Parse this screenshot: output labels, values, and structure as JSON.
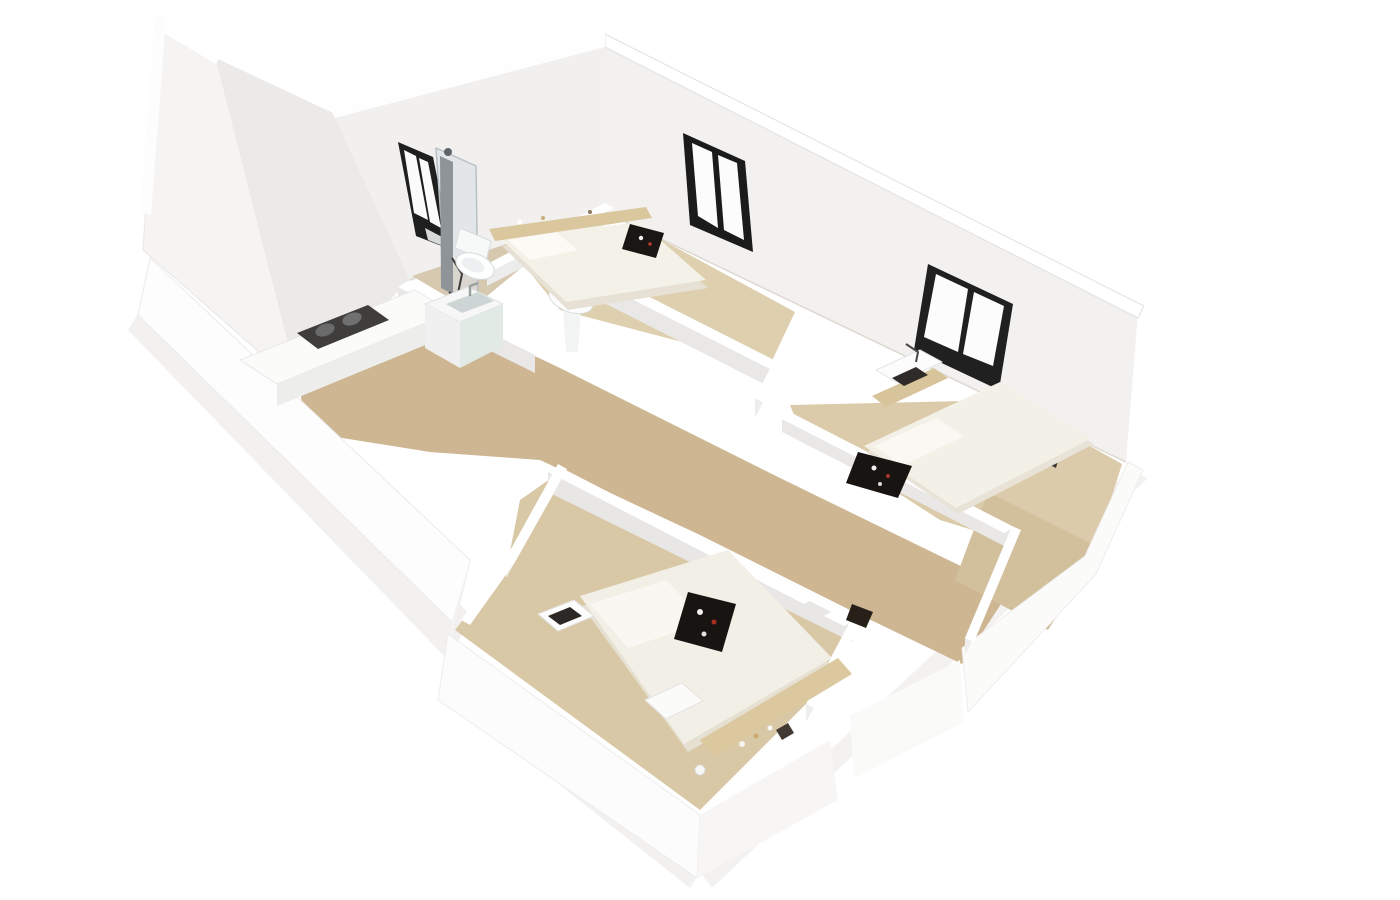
{
  "figure": {
    "kind": "3d-floor-plan-render",
    "description": "Isometric dollhouse cutaway render of a three-bedroom apartment with white walls and light wood floors",
    "rooms": [
      {
        "name": "kitchen",
        "furniture": [
          "counter",
          "gas-hob",
          "sink-cabinet"
        ]
      },
      {
        "name": "bathroom",
        "furniture": [
          "shower-column",
          "toilet",
          "window"
        ]
      },
      {
        "name": "hallway",
        "furniture": [
          "pedestal-sink",
          "bag"
        ]
      },
      {
        "name": "bedroom-1",
        "furniture": [
          "double-bed",
          "headboard-shelf",
          "breakfast-tray",
          "window"
        ]
      },
      {
        "name": "bedroom-2",
        "furniture": [
          "double-bed",
          "desk",
          "laptop",
          "desk-lamp",
          "breakfast-tray",
          "window"
        ]
      },
      {
        "name": "bedroom-3",
        "furniture": [
          "double-bed",
          "headboard-shelf",
          "breakfast-tray",
          "desk",
          "laptop",
          "stool",
          "bedside-lamp"
        ]
      }
    ],
    "palette": {
      "background": "#ffffff",
      "floor_wood": "#cdb691",
      "floor_light": "#decfae",
      "wall_top": "#ffffff",
      "wall_face": "#f2f1f0",
      "wall_shadow": "#e9e8e7",
      "window_frame": "#1f1f1f",
      "bedding": "#f3f0e7",
      "wood_trim": "#dbc79e",
      "tray_dark": "#181512",
      "accent_red": "#aa3429",
      "fixture_white": "#f7f9f9"
    }
  },
  "scene": {
    "width": 1400,
    "height": 900,
    "background": "#ffffff",
    "shapes": [
      {
        "n": "ground-shadow-west",
        "t": "p",
        "p": "140,310 468,612 452,664 128,330",
        "f": "#f2f1f0"
      },
      {
        "n": "ground-shadow-south",
        "t": "p",
        "p": "452,664 700,872 690,888 440,690",
        "f": "#f2f1f0"
      },
      {
        "n": "ground-shadow-east",
        "t": "p",
        "p": "700,872 1130,470 1148,478 712,888",
        "f": "#f3f2f1"
      },
      {
        "n": "wall-west-tall-face",
        "t": "p",
        "p": "158,16 216,58 300,388 143,250",
        "f": "#f5f4f3",
        "s": "#e8e7e6",
        "w": 1
      },
      {
        "n": "wall-west-step-face",
        "t": "p",
        "p": "216,58 333,113 410,280 300,388",
        "f": "#eceae9"
      },
      {
        "n": "wall-northwest-bath-face",
        "t": "p",
        "p": "333,113 605,42 605,212 410,280",
        "f": "#f1f0ef"
      },
      {
        "n": "wall-west-top-strip",
        "t": "p",
        "p": "155,13 222,53 216,64 149,24",
        "f": "#ffffff"
      },
      {
        "n": "wall-west-edge-strip",
        "t": "p",
        "p": "155,13 140,212 151,215 166,19",
        "f": "#fdfdfd"
      },
      {
        "n": "wall-northeast-face",
        "t": "p",
        "p": "605,42 1138,312 1126,462 605,212",
        "f": "#f2f1f0"
      },
      {
        "n": "wall-northeast-top-strip",
        "t": "p",
        "p": "605,34 1144,306 1138,318 605,47",
        "f": "#ffffff",
        "s": "#e2e1e0",
        "w": 1
      },
      {
        "n": "wall-northwest-top-strip",
        "t": "p",
        "p": "329,106 605,34 605,47 335,118",
        "f": "#fefefe"
      },
      {
        "n": "wall-northeast-floor-line",
        "t": "l",
        "p": "605,212 1126,462",
        "s": "#ddd8d0",
        "w": 1.5
      },
      {
        "n": "wall-northwest-floor-line",
        "t": "l",
        "p": "410,280 605,212",
        "s": "#ddd8d0",
        "w": 1.5
      },
      {
        "n": "bathroom-window-frame",
        "t": "p",
        "p": "398,142 433,157 452,250 416,236",
        "f": "#1f1f1f"
      },
      {
        "n": "bathroom-window-pane-1",
        "t": "p",
        "p": "404,150 416,156 428,220 414,213",
        "f": "#fbfbfc"
      },
      {
        "n": "bathroom-window-pane-2",
        "t": "p",
        "p": "419,158 428,162 441,228 430,222",
        "f": "#fbfbfc"
      },
      {
        "n": "bathroom-window-pane-3",
        "t": "p",
        "p": "425,228 444,238 448,248 428,240",
        "f": "#d8d9d9"
      },
      {
        "n": "bedroom1-window-frame",
        "t": "p",
        "p": "683,133 745,161 753,252 690,225",
        "f": "#1b1b1b"
      },
      {
        "n": "bedroom1-window-pane-1",
        "t": "p",
        "p": "692,143 712,152 718,228 698,216",
        "f": "#fcfcfd"
      },
      {
        "n": "bedroom1-window-pane-2",
        "t": "p",
        "p": "718,155 737,163 744,240 724,230",
        "f": "#fcfcfd"
      },
      {
        "n": "bedroom2-window-frame",
        "t": "p",
        "p": "928,264 1013,304 999,390 914,350",
        "f": "#202020"
      },
      {
        "n": "bedroom2-window-pane-1",
        "t": "p",
        "p": "936,274 968,289 958,352 924,337",
        "f": "#fcfcfd"
      },
      {
        "n": "bedroom2-window-pane-2",
        "t": "p",
        "p": "974,292 1004,306 993,366 963,354",
        "f": "#fcfcfd"
      },
      {
        "n": "floor-kitchen-hall",
        "t": "p",
        "p": "300,388 448,316 505,342 560,368 780,478 1010,590 962,664 850,610 700,535 540,460 430,452 305,432",
        "f": "#cdb691"
      },
      {
        "n": "floor-bathroom",
        "t": "p",
        "p": "412,276 604,211 548,246 470,310",
        "f": "#d7c9b0"
      },
      {
        "n": "floor-bedroom1",
        "t": "p",
        "p": "520,260 640,228 795,312 770,365 560,310",
        "f": "#decfae"
      },
      {
        "n": "floor-bedroom2",
        "t": "p",
        "p": "790,405 1008,400 1122,464 1090,566 940,520 800,430",
        "f": "#dccbaa"
      },
      {
        "n": "floor-bedroom3",
        "t": "p",
        "p": "520,500 560,472 850,622 808,702 700,810 455,630 508,562",
        "f": "#d9c8a6"
      },
      {
        "n": "floor-hall-exit",
        "t": "p",
        "p": "988,492 1100,548 1048,630 955,580",
        "f": "#d2bf9c"
      },
      {
        "n": "wall-southwest-band",
        "t": "p",
        "p": "150,258 470,560 455,625 138,315",
        "f": "#fdfdfd",
        "s": "#ecebea",
        "w": 1
      },
      {
        "n": "wall-southwest-jog-band",
        "t": "p",
        "p": "470,560 448,634 438,700 455,625",
        "f": "#f4f3f2"
      },
      {
        "n": "wall-bedroom3-southwest-band",
        "t": "p",
        "p": "448,634 700,815 697,878 438,700",
        "f": "#fcfcfc",
        "s": "#eeedec",
        "w": 1
      },
      {
        "n": "wall-bedroom3-southeast-band",
        "t": "p",
        "p": "700,815 830,740 838,800 697,878",
        "f": "#f7f6f5"
      },
      {
        "n": "wall-hall-exit-band",
        "t": "p",
        "p": "850,716 960,660 964,722 854,778",
        "f": "#fafaf9"
      },
      {
        "n": "wall-southeast-band",
        "t": "p",
        "p": "962,648 1085,556 1128,462 1143,470 1096,574 968,712",
        "f": "#fbfbfa",
        "s": "#eeedec",
        "w": 1
      },
      {
        "n": "wall-east-corner-band",
        "t": "p",
        "p": "1128,458 1140,314 1150,330 1144,470",
        "f": "#ffffff"
      },
      {
        "n": "wall-bathroom-south-side",
        "t": "p",
        "p": "398,285 535,353 535,373 398,305",
        "f": "#e9e8e7"
      },
      {
        "n": "wall-bathroom-south-top",
        "t": "p",
        "p": "408,281 545,349 535,355 398,287",
        "f": "#ffffff"
      },
      {
        "n": "wall-bathroom-east-side",
        "t": "p",
        "p": "487,266 605,205 605,225 487,286",
        "f": "#edecec"
      },
      {
        "n": "wall-bathroom-east-top",
        "t": "p",
        "p": "605,203 614,208 496,269 487,264",
        "f": "#ffffff"
      },
      {
        "n": "wall-bedroom1-south-side",
        "t": "p",
        "p": "529,245 772,368 772,388 529,265",
        "f": "#e9e8e7"
      },
      {
        "n": "wall-bedroom1-south-top",
        "t": "p",
        "p": "539,241 782,364 772,370 529,247",
        "f": "#ffffff"
      },
      {
        "n": "wall-bedroom1-2-divider-side",
        "t": "p",
        "p": "755,400 797,318 797,336 755,418",
        "f": "#eeedec"
      },
      {
        "n": "wall-bedroom1-2-divider-top",
        "t": "p",
        "p": "797,316 806,321 764,403 755,398",
        "f": "#ffffff"
      },
      {
        "n": "wall-bedroom2-south-side",
        "t": "p",
        "p": "782,412 1012,530 1012,550 782,432",
        "f": "#e9e8e7"
      },
      {
        "n": "wall-bedroom2-south-top",
        "t": "p",
        "p": "782,408 1014,527 1004,533 772,414",
        "f": "#ffffff"
      },
      {
        "n": "wall-hall-east-side",
        "t": "p",
        "p": "965,638 1012,528 1012,546 965,656",
        "f": "#efeeed"
      },
      {
        "n": "wall-hall-east-top",
        "t": "p",
        "p": "1012,526 1021,530 974,642 965,638",
        "f": "#ffffff"
      },
      {
        "n": "wall-bedroom3-north-side",
        "t": "p",
        "p": "548,472 852,622 852,642 548,492",
        "f": "#e8e7e6"
      },
      {
        "n": "wall-bedroom3-north-top",
        "t": "p",
        "p": "558,466 814,598 804,604 548,472",
        "f": "#ffffff"
      },
      {
        "n": "wall-bedroom3-door-stub-top",
        "t": "p",
        "p": "834,610 854,620 844,626 824,616",
        "f": "#ffffff"
      },
      {
        "n": "wall-bedroom3-west-side",
        "t": "p",
        "p": "506,560 558,468 558,486 506,578",
        "f": "#eeedec"
      },
      {
        "n": "wall-bedroom3-west-top",
        "t": "p",
        "p": "558,464 567,469 515,562 470,625 461,620 506,558",
        "f": "#ffffff"
      },
      {
        "n": "wall-bedroom3-east-side",
        "t": "p",
        "p": "806,704 852,620 852,638 806,722",
        "f": "#efeeed"
      },
      {
        "n": "wall-bedroom3-east-top",
        "t": "p",
        "p": "852,618 861,622 815,708 806,704",
        "f": "#ffffff"
      },
      {
        "n": "wardrobe-dark-panel",
        "t": "p",
        "p": "1046,438 1062,446 1056,468 1040,460",
        "f": "#3a3632"
      },
      {
        "n": "shower-glass",
        "t": "p",
        "p": "436,148 476,166 478,298 446,290",
        "f": "#d9dfe2",
        "o": 0.6,
        "s": "#b9c0c4",
        "w": 1.5
      },
      {
        "n": "shower-column",
        "t": "p",
        "p": "440,156 453,162 453,294 441,288",
        "f": "#8f9498"
      },
      {
        "n": "shower-head",
        "t": "c",
        "cx": 448,
        "cy": 152,
        "r": 4,
        "f": "#5f6468"
      },
      {
        "n": "shower-hose",
        "t": "l",
        "p": "452,258 462,274 457,298 449,292",
        "s": "#3e3c3a",
        "w": 2
      },
      {
        "n": "toilet-tank",
        "t": "p",
        "p": "460,228 491,241 486,261 455,248",
        "f": "#f7f9f9",
        "s": "#d9dddd",
        "w": 1
      },
      {
        "n": "toilet-bowl",
        "t": "e",
        "cx": 475,
        "cy": 266,
        "rx": 20,
        "ry": 12,
        "rot": 22,
        "f": "#fdfefe",
        "s": "#d7dbdb",
        "w": 1
      },
      {
        "n": "toilet-seat",
        "t": "e",
        "cx": 473,
        "cy": 265,
        "rx": 12,
        "ry": 6.5,
        "rot": 22,
        "f": "#edf0f0"
      },
      {
        "n": "pedestal-sink-column",
        "t": "p",
        "p": "563,308 581,308 578,352 566,352",
        "f": "#f3f5f5"
      },
      {
        "n": "pedestal-sink-bowl",
        "t": "e",
        "cx": 571,
        "cy": 299,
        "rx": 23,
        "ry": 13,
        "rot": 20,
        "f": "#fdfdfd",
        "s": "#d9dddd",
        "w": 1
      },
      {
        "n": "pedestal-sink-basin",
        "t": "e",
        "cx": 570,
        "cy": 298,
        "rx": 14,
        "ry": 7,
        "rot": 20,
        "f": "#eef1f1"
      },
      {
        "n": "kitchen-counter-top",
        "t": "p",
        "p": "240,360 415,290 452,312 277,384",
        "f": "#fbfbfa",
        "s": "#e9e8e7",
        "w": 1
      },
      {
        "n": "kitchen-counter-front",
        "t": "p",
        "p": "277,384 452,312 452,334 277,406",
        "f": "#ededec"
      },
      {
        "n": "kitchen-hob",
        "t": "p",
        "p": "297,333 368,305 389,320 318,349",
        "f": "#3f3e3d"
      },
      {
        "n": "hob-burner-1",
        "t": "e",
        "cx": 325,
        "cy": 330,
        "rx": 10,
        "ry": 6,
        "rot": -20,
        "f": "#6a6a6a"
      },
      {
        "n": "hob-burner-2",
        "t": "e",
        "cx": 352,
        "cy": 319,
        "rx": 10,
        "ry": 6,
        "rot": -20,
        "f": "#707070"
      },
      {
        "n": "sink-cabinet-top",
        "t": "p",
        "p": "425,304 468,287 503,304 460,322",
        "f": "#f6f7f6",
        "s": "#e2e3e2",
        "w": 1
      },
      {
        "n": "sink-cabinet-left",
        "t": "p",
        "p": "425,304 460,322 460,368 425,348",
        "f": "#eff0ef"
      },
      {
        "n": "sink-cabinet-right",
        "t": "p",
        "p": "460,322 503,304 503,346 460,368",
        "f": "#e2eae6"
      },
      {
        "n": "sink-cabinet-basin",
        "t": "p",
        "p": "446,304 478,292 494,301 462,313",
        "f": "#ced5d5"
      },
      {
        "n": "sink-faucet",
        "t": "l",
        "p": "470,296 470,286 478,283",
        "s": "#9aa0a0",
        "w": 2.5
      },
      {
        "n": "bed1-base",
        "t": "p",
        "p": "502,246 640,230 708,288 568,310",
        "f": "#e6e1d4"
      },
      {
        "n": "bed1-duvet",
        "t": "p",
        "p": "500,238 640,222 706,280 566,302",
        "f": "#f4f1e8"
      },
      {
        "n": "bed1-pillow",
        "t": "p",
        "p": "508,240 556,232 578,250 530,260",
        "f": "#fbfaf5"
      },
      {
        "n": "bed1-headboard-shelf",
        "t": "p",
        "p": "489,229 646,207 652,218 495,241",
        "f": "#dbc79e"
      },
      {
        "n": "bed1-decor-1",
        "t": "c",
        "cx": 520,
        "cy": 222,
        "r": 2.5,
        "f": "#fdfdfd"
      },
      {
        "n": "bed1-decor-2",
        "t": "c",
        "cx": 543,
        "cy": 218,
        "r": 2,
        "f": "#c9ae79"
      },
      {
        "n": "bed1-decor-3",
        "t": "c",
        "cx": 566,
        "cy": 215,
        "r": 2.5,
        "f": "#f3efe6"
      },
      {
        "n": "bed1-decor-4",
        "t": "c",
        "cx": 590,
        "cy": 212,
        "r": 2,
        "f": "#8a7a5c"
      },
      {
        "n": "bed1-tray",
        "t": "p",
        "p": "630,224 664,233 656,258 622,249",
        "f": "#191613"
      },
      {
        "n": "bed1-tray-dish",
        "t": "c",
        "cx": 641,
        "cy": 238,
        "r": 2.2,
        "f": "#f2f2f2"
      },
      {
        "n": "bed1-tray-accent",
        "t": "c",
        "cx": 650,
        "cy": 244,
        "r": 1.8,
        "f": "#b8382c"
      },
      {
        "n": "bedroom2-desk-base",
        "t": "p",
        "p": "872,396 934,368 948,378 886,407",
        "f": "#d8c49b"
      },
      {
        "n": "bedroom2-desk-top",
        "t": "p",
        "p": "876,370 920,350 942,362 898,383",
        "f": "#fcfcfc",
        "s": "#e4e4e3",
        "w": 1
      },
      {
        "n": "bedroom2-laptop",
        "t": "p",
        "p": "892,378 916,367 928,375 904,386",
        "f": "#2f2b28"
      },
      {
        "n": "bedroom2-desk-lamp",
        "t": "l",
        "p": "906,344 918,352 916,362",
        "s": "#4a4745",
        "w": 2
      },
      {
        "n": "bed2-base",
        "t": "p",
        "p": "866,452 1002,388 1094,444 958,514",
        "f": "#e8e3d6"
      },
      {
        "n": "bed2-duvet",
        "t": "p",
        "p": "864,446 1000,382 1092,438 956,508",
        "f": "#f3f0e7"
      },
      {
        "n": "bed2-pillow",
        "t": "p",
        "p": "874,446 936,418 964,436 902,466",
        "f": "#faf8f2"
      },
      {
        "n": "bed2-tray",
        "t": "p",
        "p": "858,452 912,466 898,498 846,483",
        "f": "#171411"
      },
      {
        "n": "bed2-tray-dish",
        "t": "c",
        "cx": 874,
        "cy": 468,
        "r": 2.5,
        "f": "#f0f0f0"
      },
      {
        "n": "bed2-tray-accent",
        "t": "c",
        "cx": 888,
        "cy": 476,
        "r": 2,
        "f": "#aa3429"
      },
      {
        "n": "bed2-tray-cup",
        "t": "c",
        "cx": 880,
        "cy": 484,
        "r": 2,
        "f": "#dcdcdc"
      },
      {
        "n": "bed3-base",
        "t": "p",
        "p": "582,606 728,560 834,668 688,752",
        "f": "#e5e0d2"
      },
      {
        "n": "bed3-duvet",
        "t": "p",
        "p": "580,596 728,550 832,658 684,744",
        "f": "#f2efe6"
      },
      {
        "n": "bed3-pillow",
        "t": "p",
        "p": "590,604 666,580 706,622 628,648",
        "f": "#f9f7f1"
      },
      {
        "n": "bed3-headboard-shelf",
        "t": "p",
        "p": "700,740 838,658 852,674 714,757",
        "f": "#dcc89f"
      },
      {
        "n": "bed3-tray",
        "t": "p",
        "p": "688,592 736,604 722,652 674,639",
        "f": "#181411"
      },
      {
        "n": "bed3-tray-dish",
        "t": "c",
        "cx": 700,
        "cy": 612,
        "r": 3,
        "f": "#f2f2f2"
      },
      {
        "n": "bed3-tray-accent",
        "t": "c",
        "cx": 714,
        "cy": 622,
        "r": 2.5,
        "f": "#a5301f"
      },
      {
        "n": "bed3-tray-cup",
        "t": "c",
        "cx": 704,
        "cy": 634,
        "r": 2.5,
        "f": "#e3e3e3"
      },
      {
        "n": "bed3-decor-1",
        "t": "c",
        "cx": 742,
        "cy": 744,
        "r": 3,
        "f": "#f6f4ee"
      },
      {
        "n": "bed3-decor-2",
        "t": "c",
        "cx": 756,
        "cy": 736,
        "r": 2.5,
        "f": "#c9a96e"
      },
      {
        "n": "bed3-decor-3",
        "t": "c",
        "cx": 770,
        "cy": 728,
        "r": 2.5,
        "f": "#fbfaf7"
      },
      {
        "n": "bed3-decor-box",
        "t": "p",
        "p": "776,730 788,723 794,733 782,740",
        "f": "#423a32"
      },
      {
        "n": "bedroom3-desk-top",
        "t": "p",
        "p": "538,614 574,600 594,616 558,631",
        "f": "#fcfcfc",
        "s": "#e3e3e2",
        "w": 1
      },
      {
        "n": "bedroom3-laptop",
        "t": "p",
        "p": "548,616 570,607 582,616 560,625",
        "f": "#2c2825"
      },
      {
        "n": "bedroom3-stool",
        "t": "p",
        "p": "645,700 682,683 703,701 666,719",
        "f": "#fbfbfa",
        "s": "#e5e4e3",
        "w": 1
      },
      {
        "n": "bedroom3-bedside-lamp",
        "t": "c",
        "cx": 700,
        "cy": 770,
        "r": 5,
        "f": "#f8f8f7",
        "s": "#dadada",
        "w": 1
      },
      {
        "n": "hallway-bag",
        "t": "p",
        "p": "852,604 873,612 866,628 846,620",
        "f": "#262019"
      }
    ]
  }
}
